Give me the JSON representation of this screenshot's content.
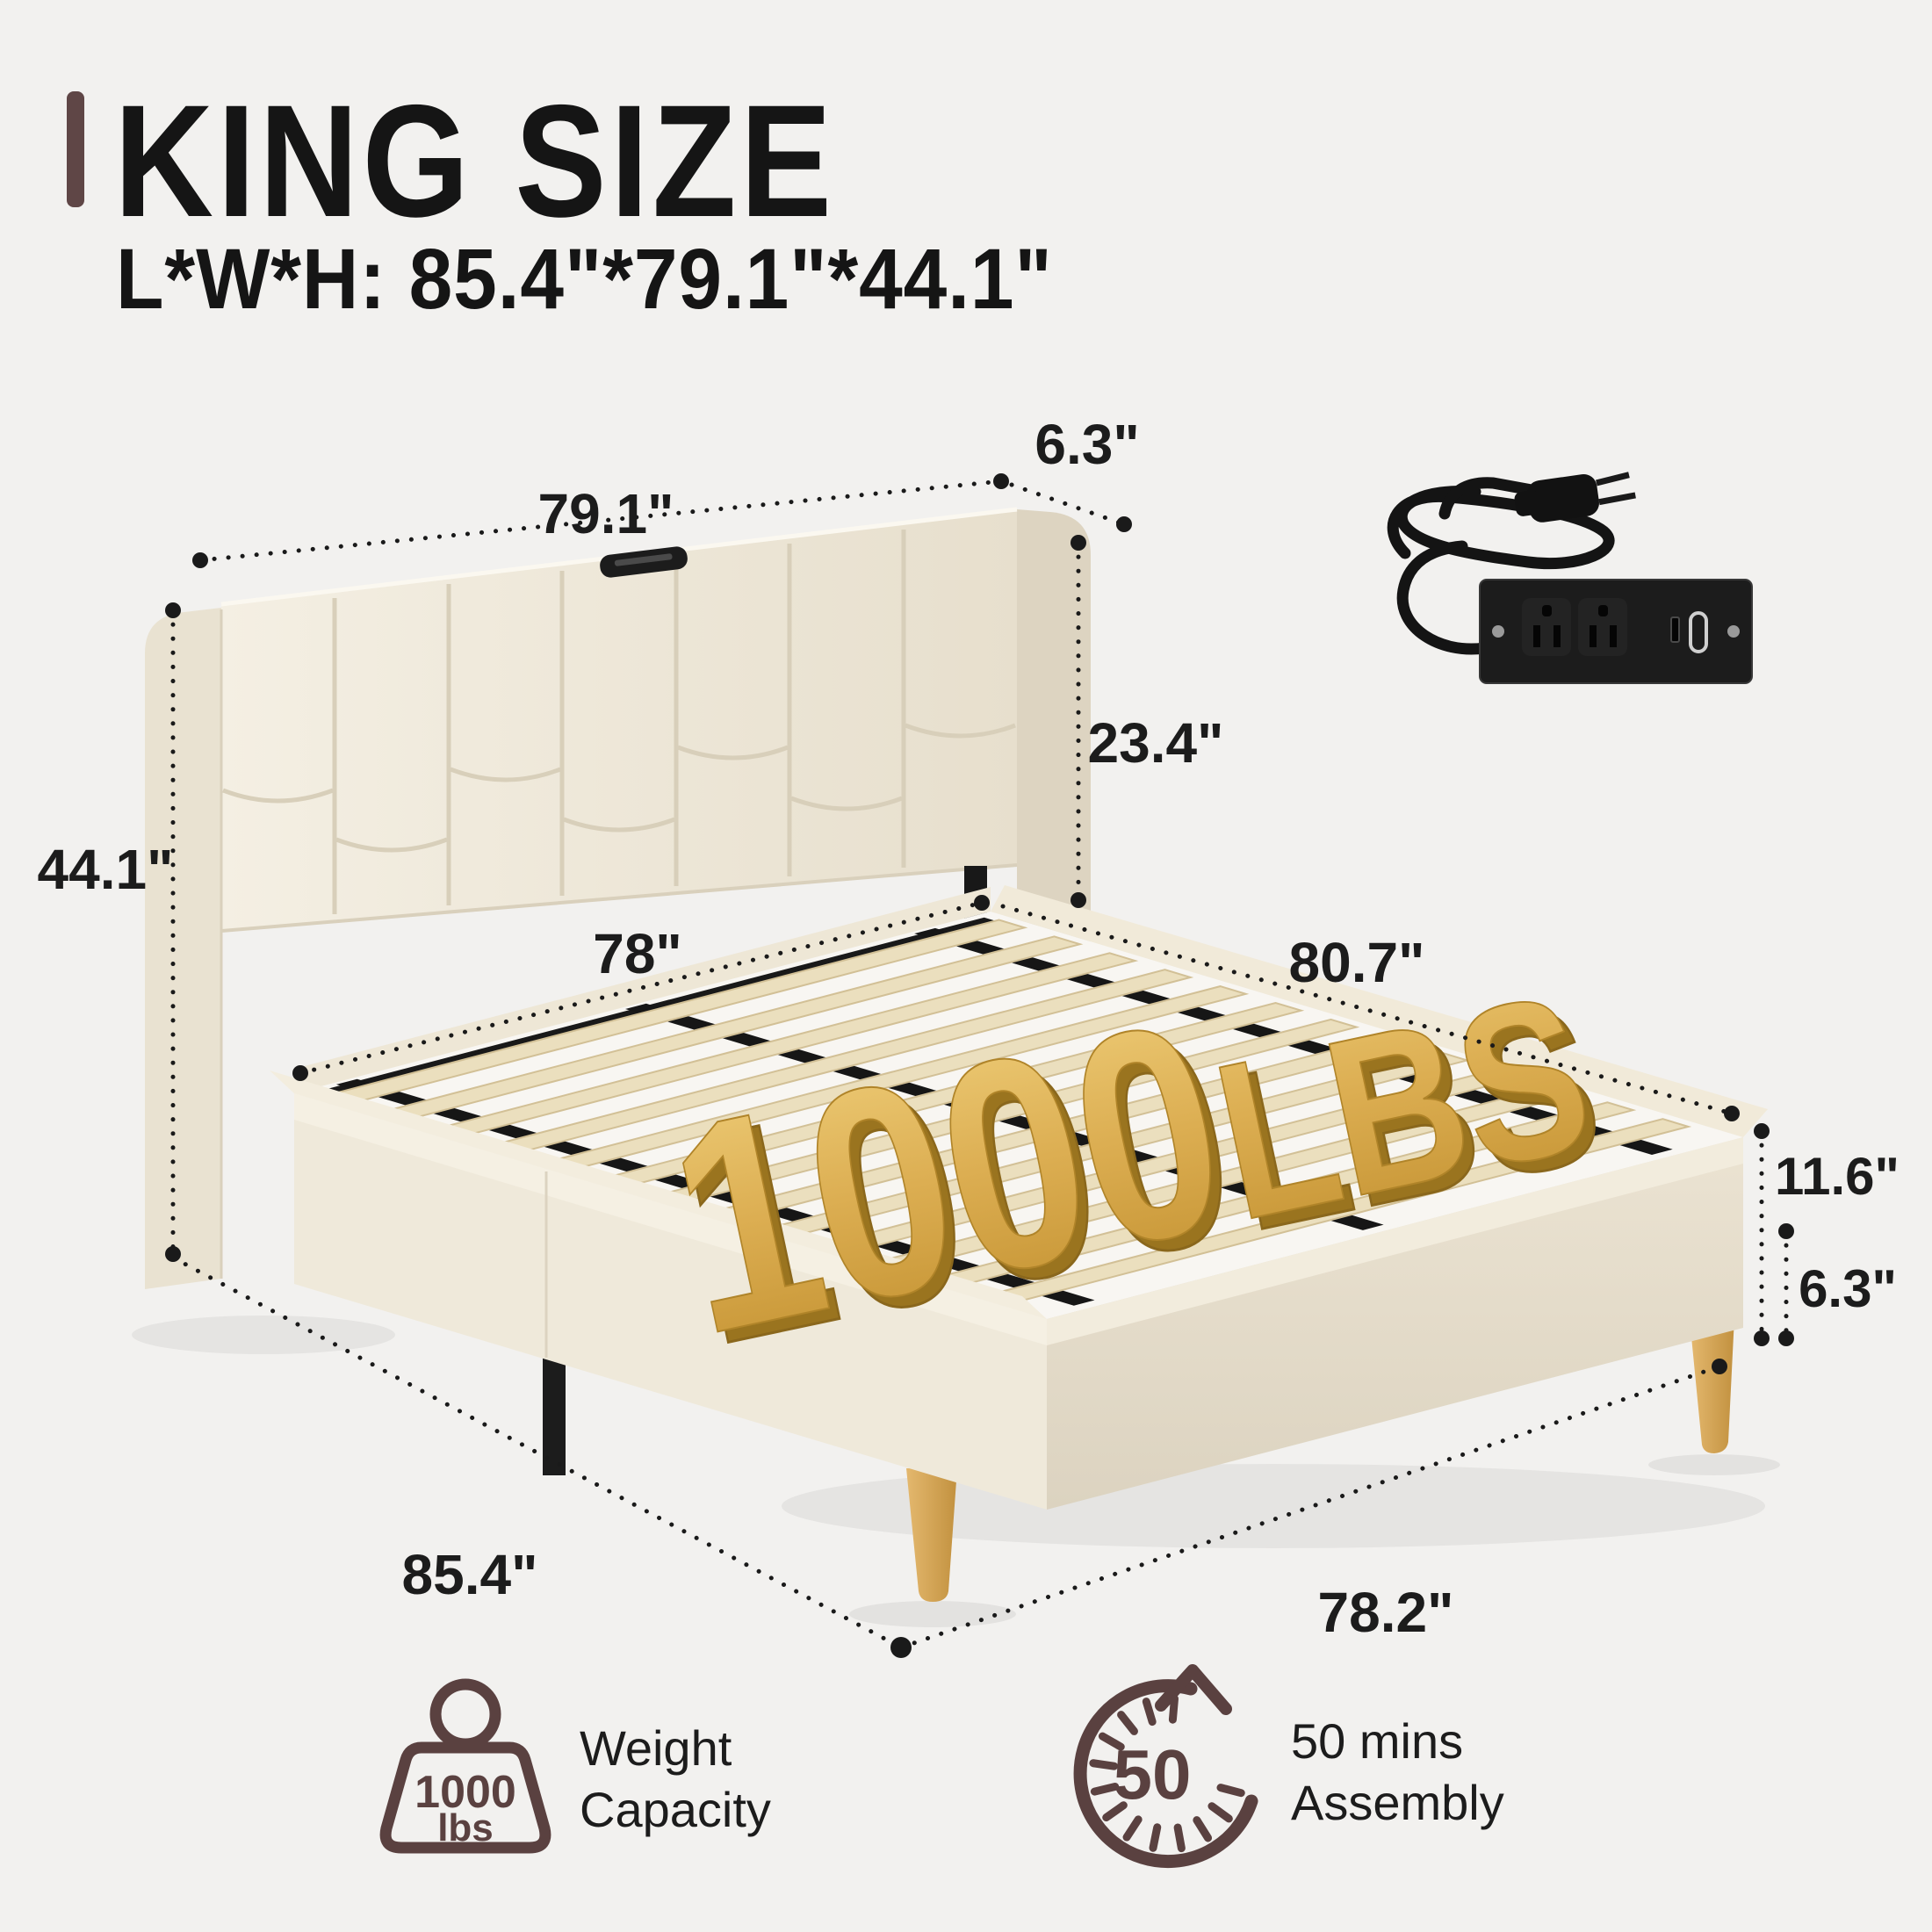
{
  "page": {
    "background": "#f2f1ef"
  },
  "header": {
    "title": "KING SIZE",
    "subtitle": "L*W*H: 85.4\"*79.1\"*44.1\""
  },
  "diagram": {
    "weight_marker": {
      "number": "1000",
      "unit": "LBS"
    },
    "dim_labels": {
      "headboard_width": "79.1\"",
      "headboard_depth": "6.3\"",
      "headboard_height": "23.4\"",
      "overall_height": "44.1\"",
      "slat_area_width": "78\"",
      "platform_length": "80.7\"",
      "platform_height": "11.6\"",
      "leg_height": "6.3\"",
      "overall_length": "85.4\"",
      "platform_width": "78.2\""
    }
  },
  "features": [
    {
      "icon": "weight-icon",
      "badge_number": "1000",
      "badge_unit": "lbs",
      "line1": "Weight",
      "line2": "Capacity"
    },
    {
      "icon": "timer-icon",
      "badge_number": "50",
      "line1": "50 mins",
      "line2": "Assembly"
    }
  ],
  "colors": {
    "accent_brown": "#5a4140",
    "title_bar_brown": "#5f4646",
    "gold": "#d9a94e",
    "fabric_cream": "#ece5d6",
    "wood": "#d9ae63",
    "line_black": "#1a1a1a",
    "background": "#f2f1ef"
  }
}
